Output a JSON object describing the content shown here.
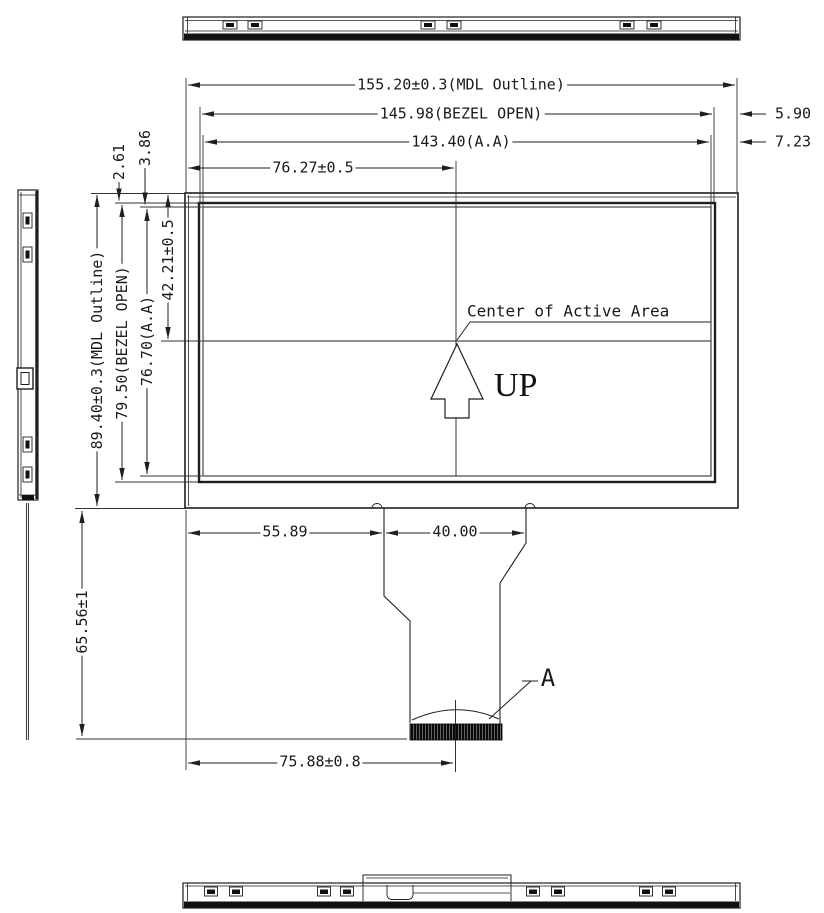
{
  "drawing": {
    "colors": {
      "line": "#1f1f1f",
      "background": "#ffffff",
      "connector_fill": "#0a0a0a"
    },
    "dims": {
      "mdl_w": "155.20±0.3(MDL Outline)",
      "bezel_w": "145.98(BEZEL OPEN)",
      "aa_w": "143.40(A.A)",
      "center_x": "76.27±0.5",
      "right_bezel": "5.90",
      "right_aa": "7.23",
      "top_bezel": "2.61",
      "top_aa": "3.86",
      "mdl_h": "89.40±0.3(MDL Outline)",
      "bezel_h": "79.50(BEZEL OPEN)",
      "aa_h": "76.70(A.A)",
      "center_y": "42.21±0.5",
      "fpc_offset": "55.89",
      "fpc_width": "40.00",
      "fpc_length": "65.56±1",
      "connector_center": "75.88±0.8"
    },
    "annotations": {
      "center_note": "Center of Active Area",
      "orientation": "UP",
      "detail_label": "A"
    }
  }
}
